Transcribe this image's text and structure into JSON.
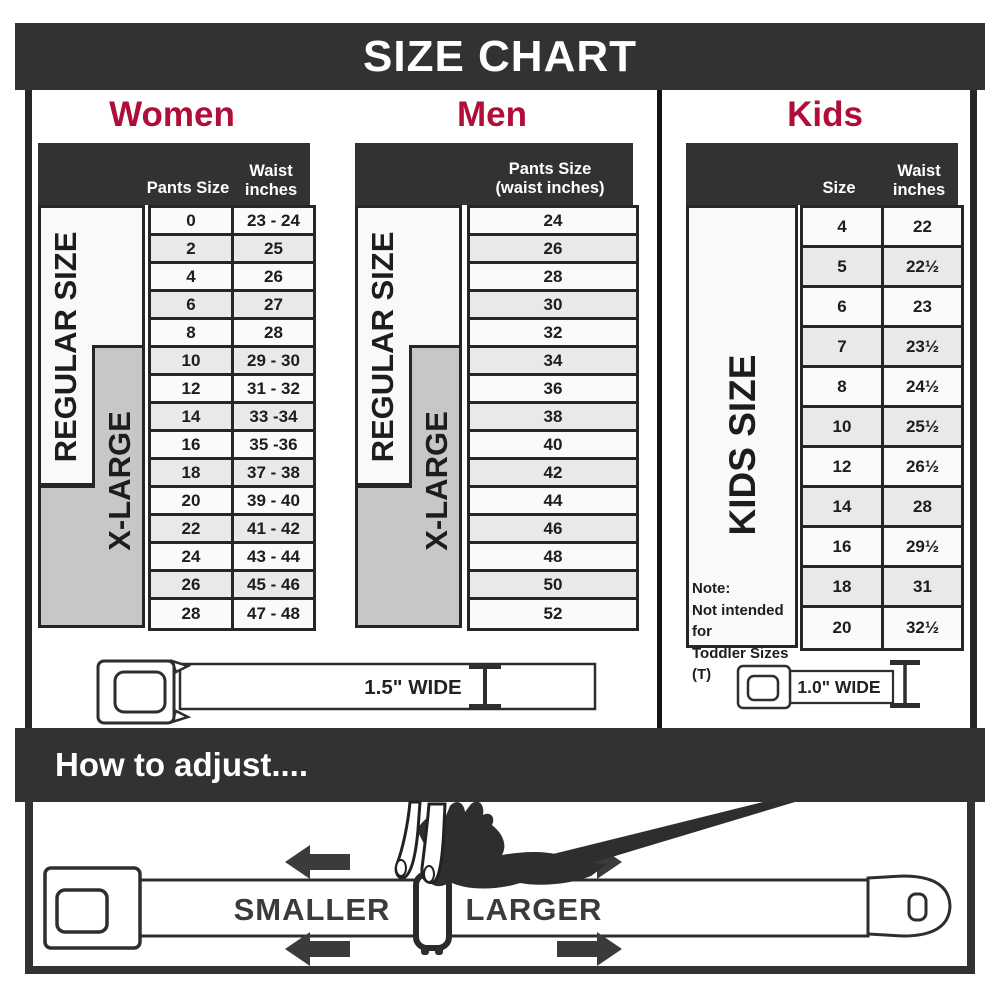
{
  "title": "SIZE CHART",
  "colors": {
    "accent_red": "#b00e38",
    "dark_bar": "#323234",
    "border": "#262626",
    "row_light": "#fafafa",
    "row_alt": "#e9e9e9",
    "xlarge_gray": "#c7c7c7"
  },
  "sections": {
    "women": {
      "heading": "Women",
      "col1_header": "Pants Size",
      "col2_header": "Waist inches",
      "regular_label": "REGULAR SIZE",
      "xlarge_label": "X-LARGE",
      "rows": [
        {
          "size": "0",
          "waist": "23 - 24"
        },
        {
          "size": "2",
          "waist": "25"
        },
        {
          "size": "4",
          "waist": "26"
        },
        {
          "size": "6",
          "waist": "27"
        },
        {
          "size": "8",
          "waist": "28"
        },
        {
          "size": "10",
          "waist": "29 - 30"
        },
        {
          "size": "12",
          "waist": "31 - 32"
        },
        {
          "size": "14",
          "waist": "33 -34"
        },
        {
          "size": "16",
          "waist": "35 -36"
        },
        {
          "size": "18",
          "waist": "37 - 38"
        },
        {
          "size": "20",
          "waist": "39 - 40"
        },
        {
          "size": "22",
          "waist": "41 - 42"
        },
        {
          "size": "24",
          "waist": "43 - 44"
        },
        {
          "size": "26",
          "waist": "45 - 46"
        },
        {
          "size": "28",
          "waist": "47 - 48"
        }
      ]
    },
    "men": {
      "heading": "Men",
      "col_header": "Pants Size (waist inches)",
      "regular_label": "REGULAR SIZE",
      "xlarge_label": "X-LARGE",
      "rows": [
        "24",
        "26",
        "28",
        "30",
        "32",
        "34",
        "36",
        "38",
        "40",
        "42",
        "44",
        "46",
        "48",
        "50",
        "52"
      ]
    },
    "kids": {
      "heading": "Kids",
      "col1_header": "Size",
      "col2_header": "Waist inches",
      "size_label": "KIDS SIZE",
      "note": [
        "Note:",
        "Not intended for",
        "Toddler Sizes (T)"
      ],
      "rows": [
        {
          "size": "4",
          "waist": "22"
        },
        {
          "size": "5",
          "waist": "22½"
        },
        {
          "size": "6",
          "waist": "23"
        },
        {
          "size": "7",
          "waist": "23½"
        },
        {
          "size": "8",
          "waist": "24½"
        },
        {
          "size": "10",
          "waist": "25½"
        },
        {
          "size": "12",
          "waist": "26½"
        },
        {
          "size": "14",
          "waist": "28"
        },
        {
          "size": "16",
          "waist": "29½"
        },
        {
          "size": "18",
          "waist": "31"
        },
        {
          "size": "20",
          "waist": "32½"
        }
      ]
    }
  },
  "belts": {
    "adult_label": "1.5\" WIDE",
    "kids_label": "1.0\" WIDE"
  },
  "adjust": {
    "title": "How to adjust....",
    "smaller": "SMALLER",
    "larger": "LARGER"
  }
}
